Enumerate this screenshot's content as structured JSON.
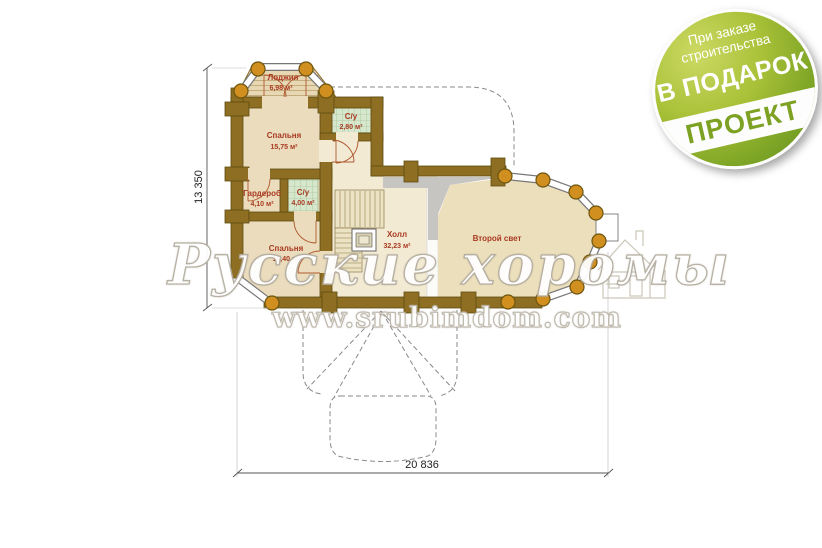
{
  "badge": {
    "line1": "При заказе",
    "line2": "строительства",
    "line3": "В ПОДАРОК",
    "line4": "ПРОЕКТ"
  },
  "watermark": {
    "brand": "Русские хоромы",
    "url": "www.srubimdom.com"
  },
  "dims": {
    "height": "13 350",
    "width": "20 836"
  },
  "rooms": {
    "loggia": {
      "name": "Лоджия",
      "area": "6,98 м²"
    },
    "bedroom1": {
      "name": "Спальня",
      "area": "15,75 м²"
    },
    "wc1": {
      "name": "С/у",
      "area": "2,80 м²"
    },
    "wardrobe": {
      "name": "Гардероб",
      "area": "4,10 м²"
    },
    "wc2": {
      "name": "С/у",
      "area": "4,00 м²"
    },
    "bedroom2": {
      "name": "Спальня",
      "area": "19,40 м²"
    },
    "hall": {
      "name": "Холл",
      "area": "32,23 м²"
    },
    "secondlight": {
      "name": "Второй свет"
    }
  },
  "colors": {
    "wall_brown": "#8d6e22",
    "log_orange": "#d18f1f",
    "floor_beige": "#eadcbd",
    "hall_floor": "#f2ead2",
    "tile_green": "#d7e7cd",
    "label_red": "#a93a22",
    "badge_green_dark": "#648c1c",
    "badge_green_light": "#ccd964",
    "void_gray": "#c6c5c2"
  }
}
